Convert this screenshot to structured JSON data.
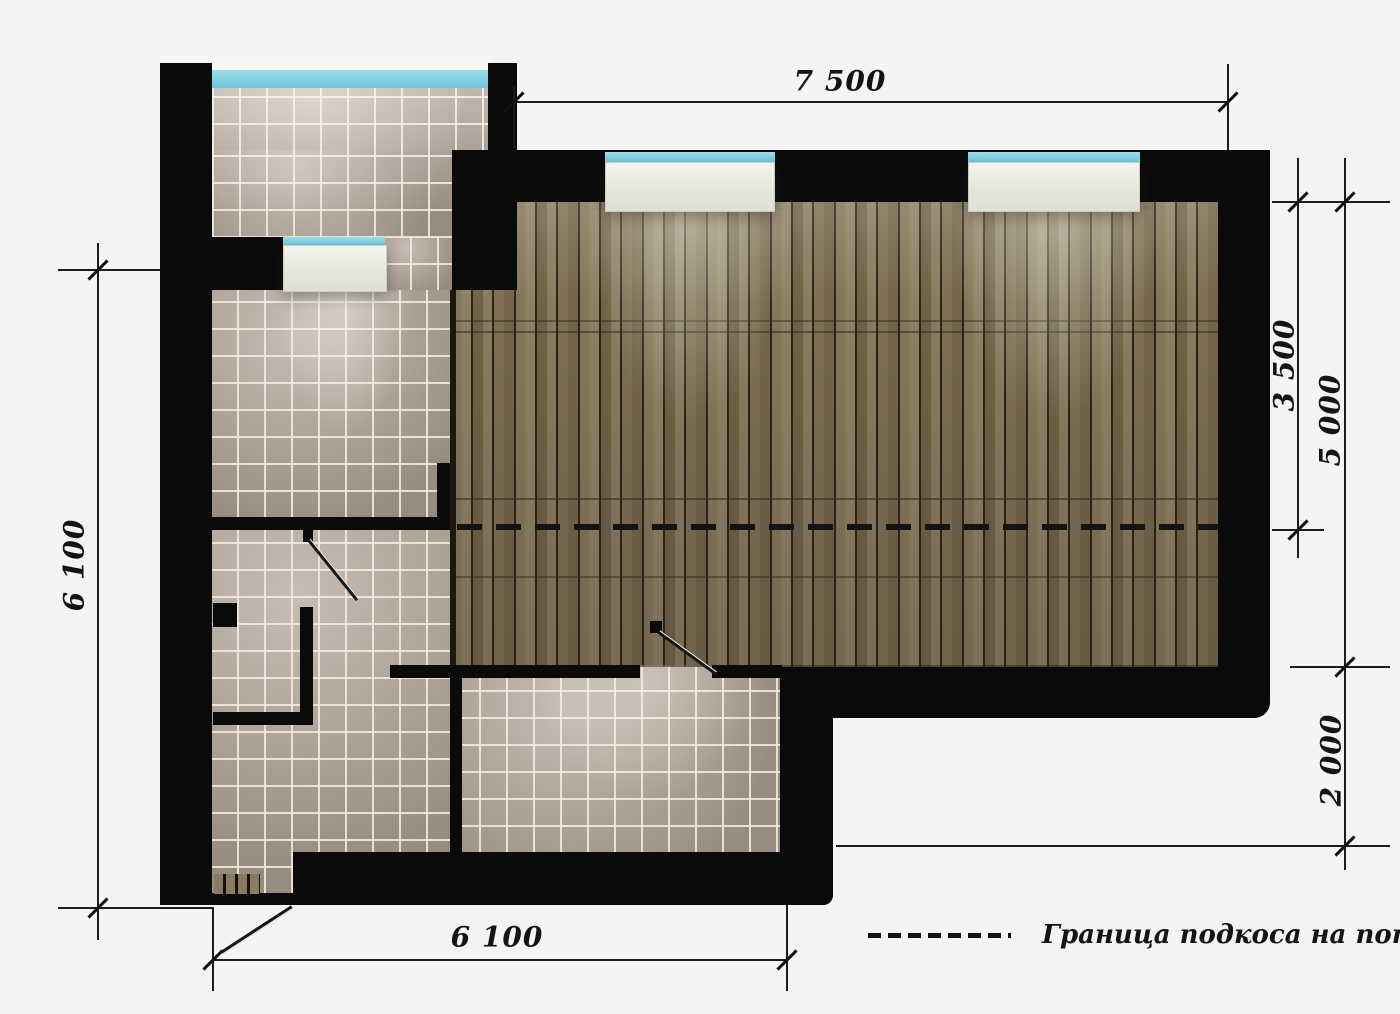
{
  "dimensions": {
    "top": "7 500",
    "right_upper": "3 500",
    "right_full": "5 000",
    "right_lower": "2 000",
    "left": "6 100",
    "bottom": "6 100"
  },
  "legend": {
    "label": "Граница подкоса на потолке"
  },
  "colors": {
    "background": "#f4f4f2",
    "wall": "#0a0a0a",
    "window_glass": "#7fcfe3",
    "window_sill": "#eef0e8",
    "tile": "#b1a496",
    "tile_grout": "#e9e2d6",
    "wood_light": "#8e7f64",
    "wood_dark": "#6f6047",
    "dimension": "#1c1c1c"
  }
}
